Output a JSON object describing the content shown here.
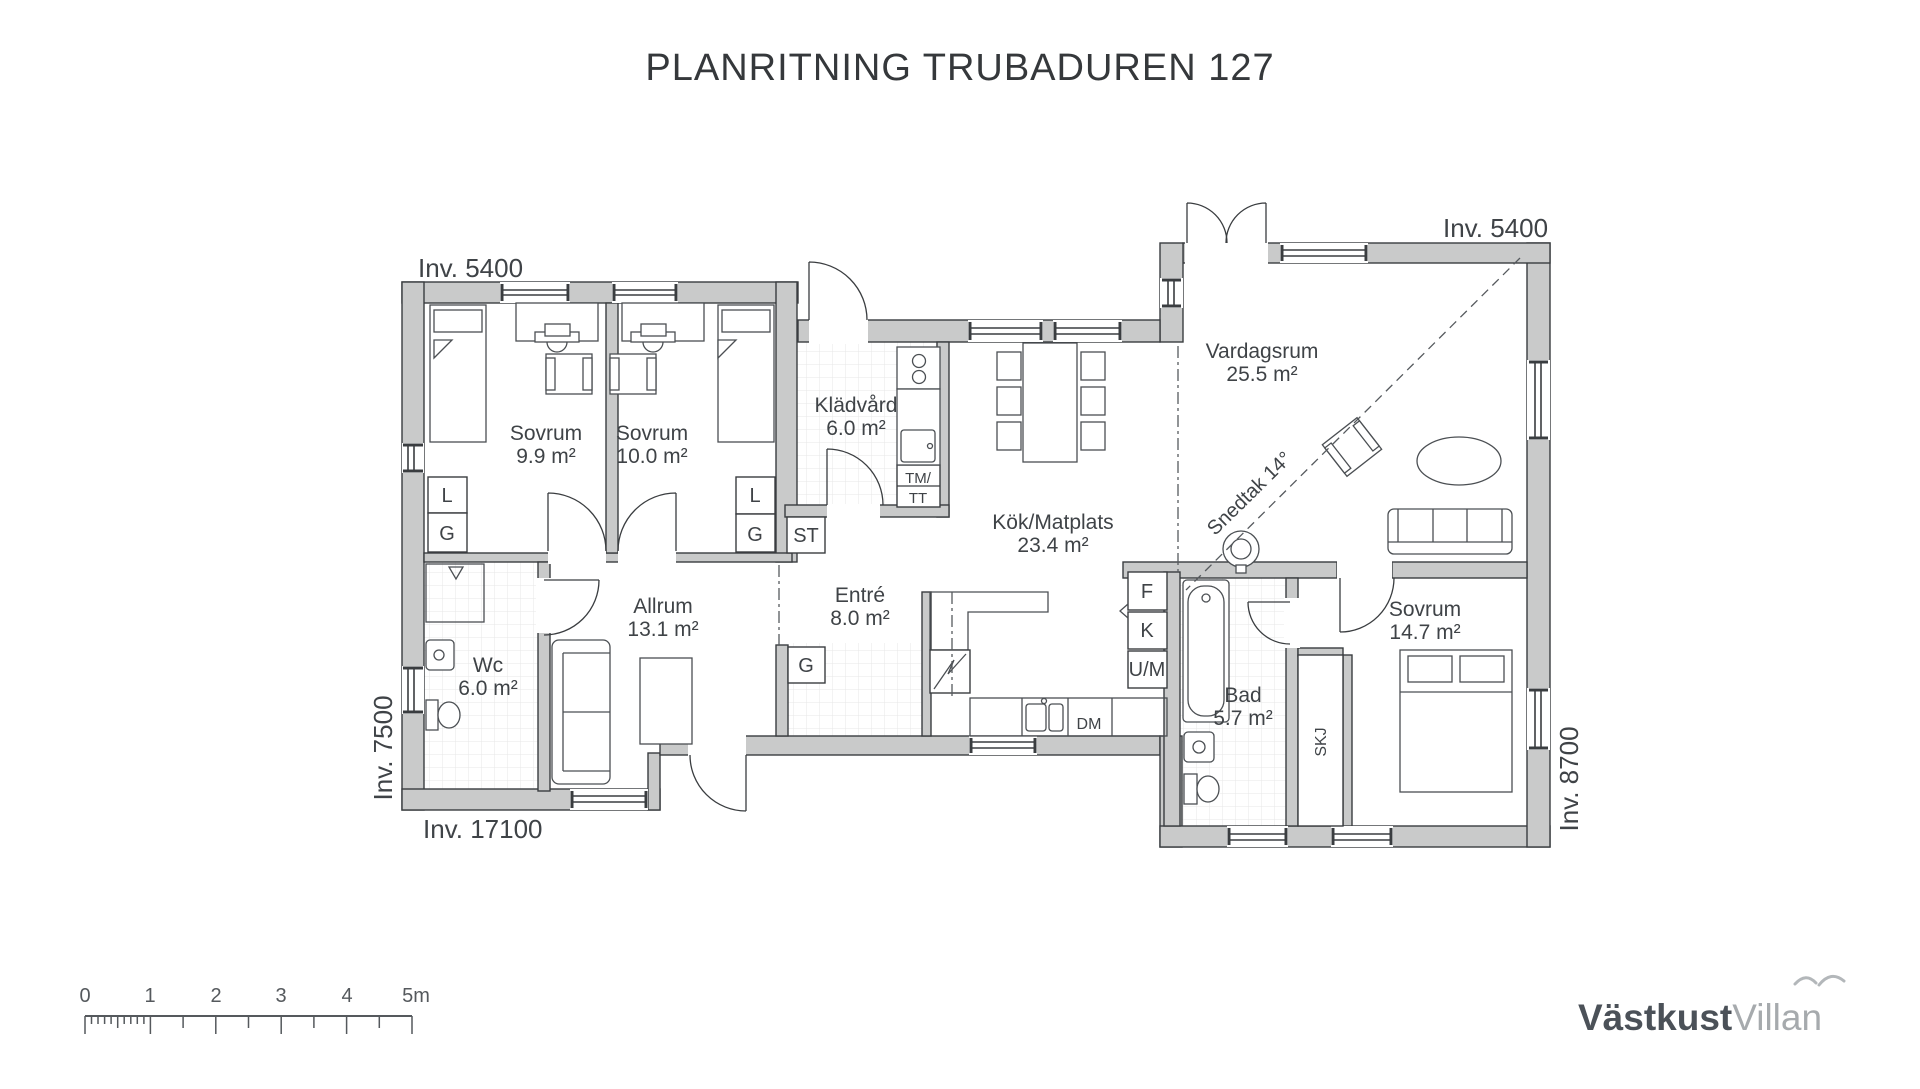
{
  "title": "PLANRITNING TRUBADUREN 127",
  "rooms": [
    {
      "name": "Sovrum",
      "area": "9.9 m²"
    },
    {
      "name": "Sovrum",
      "area": "10.0 m²"
    },
    {
      "name": "Klädvård",
      "area": "6.0 m²"
    },
    {
      "name": "Kök/Matplats",
      "area": "23.4 m²"
    },
    {
      "name": "Vardagsrum",
      "area": "25.5 m²"
    },
    {
      "name": "Allrum",
      "area": "13.1 m²"
    },
    {
      "name": "Wc",
      "area": "6.0 m²"
    },
    {
      "name": "Entré",
      "area": "8.0 m²"
    },
    {
      "name": "Bad",
      "area": "5.7 m²"
    },
    {
      "name": "Sovrum",
      "area": "14.7 m²"
    }
  ],
  "tags": {
    "linen1": "L",
    "wardrobe1": "G",
    "linen2": "L",
    "wardrobe2": "G",
    "cleaning": "ST",
    "wardrobe3": "G",
    "washer": "TM/",
    "dryer": "TT",
    "freezer": "F",
    "fridge": "K",
    "oven_micro": "U/M",
    "dishwasher": "DM",
    "sliding_wardrobe": "SKJ"
  },
  "dimensions": {
    "top_left": "Inv. 5400",
    "top_right": "Inv. 5400",
    "left": "Inv. 7500",
    "bottom_left": "Inv. 17100",
    "right": "Inv. 8700"
  },
  "annotations": {
    "sloped_ceiling": "Snedtak 14°"
  },
  "scalebar": {
    "labels": [
      "0",
      "1",
      "2",
      "3",
      "4",
      "5m"
    ]
  },
  "logo": {
    "bold": "Västkust",
    "light": "Villan"
  },
  "colors": {
    "wall_fill": "#c9caca",
    "line": "#3a3d40",
    "text": "#3f4347",
    "tile_grid": "#e7e7e7",
    "logo_dark": "#4b5158",
    "logo_light": "#a6aaad"
  }
}
